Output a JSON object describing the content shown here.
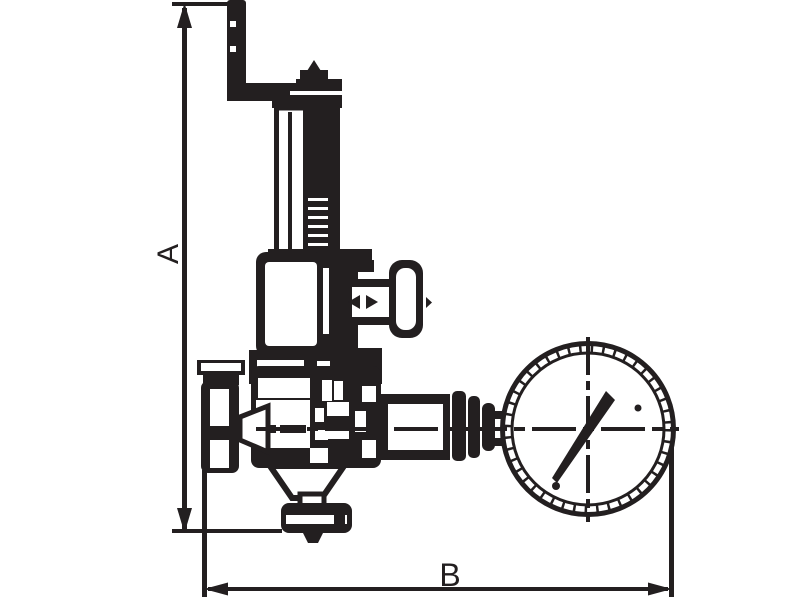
{
  "page": {
    "background": "#ffffff",
    "ink_color": "#231f20"
  },
  "diagram": {
    "subject": "pressure reducing valve with crank handle, side handwheel and pressure gauge",
    "dimensions": {
      "a": {
        "label": "A",
        "orientation": "vertical"
      },
      "b": {
        "label": "B",
        "orientation": "horizontal"
      }
    }
  }
}
